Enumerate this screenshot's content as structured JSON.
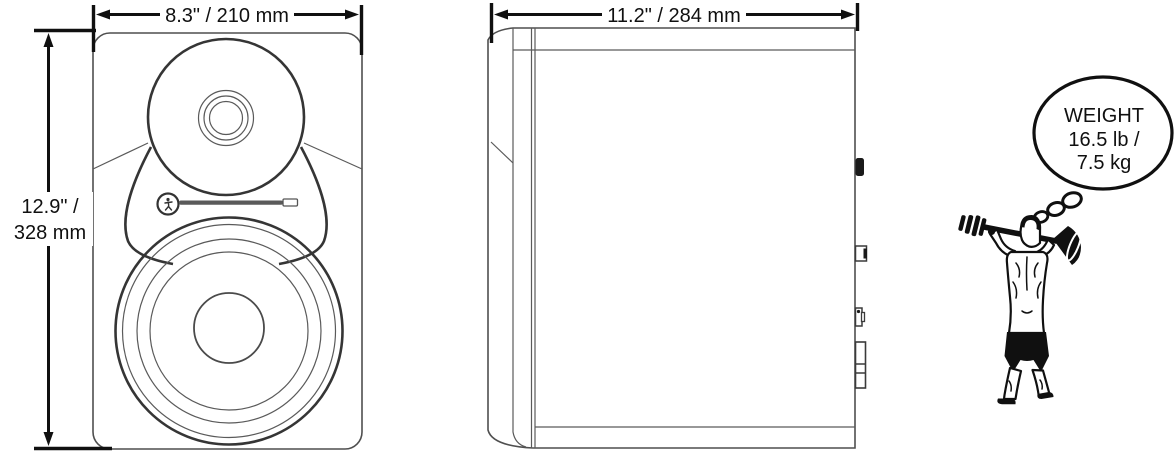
{
  "page": {
    "title": "Studio monitor dimensions diagram",
    "background": "#ffffff"
  },
  "colors": {
    "drawing_line": "#4f4f4f",
    "thick_line": "#353535",
    "ink": "#101010"
  },
  "dimensions": {
    "front_width": "8.3\" / 210 mm",
    "front_height_line1": "12.9\" /",
    "front_height_line2": "328 mm",
    "side_depth": "11.2\" / 284 mm"
  },
  "weight_callout": {
    "title": "WEIGHT",
    "pounds": "16.5 lb /",
    "kilograms": "7.5 kg"
  },
  "figures": {
    "front_view": "speaker-front-view",
    "side_view": "speaker-side-view",
    "tweeter": "tweeter-waveguide",
    "woofer": "woofer",
    "logo": "running-man-logo",
    "slot": "front-led-slot",
    "thought_bubble": "thought-bubble",
    "strongman": "strongman-lifting-barbell"
  }
}
